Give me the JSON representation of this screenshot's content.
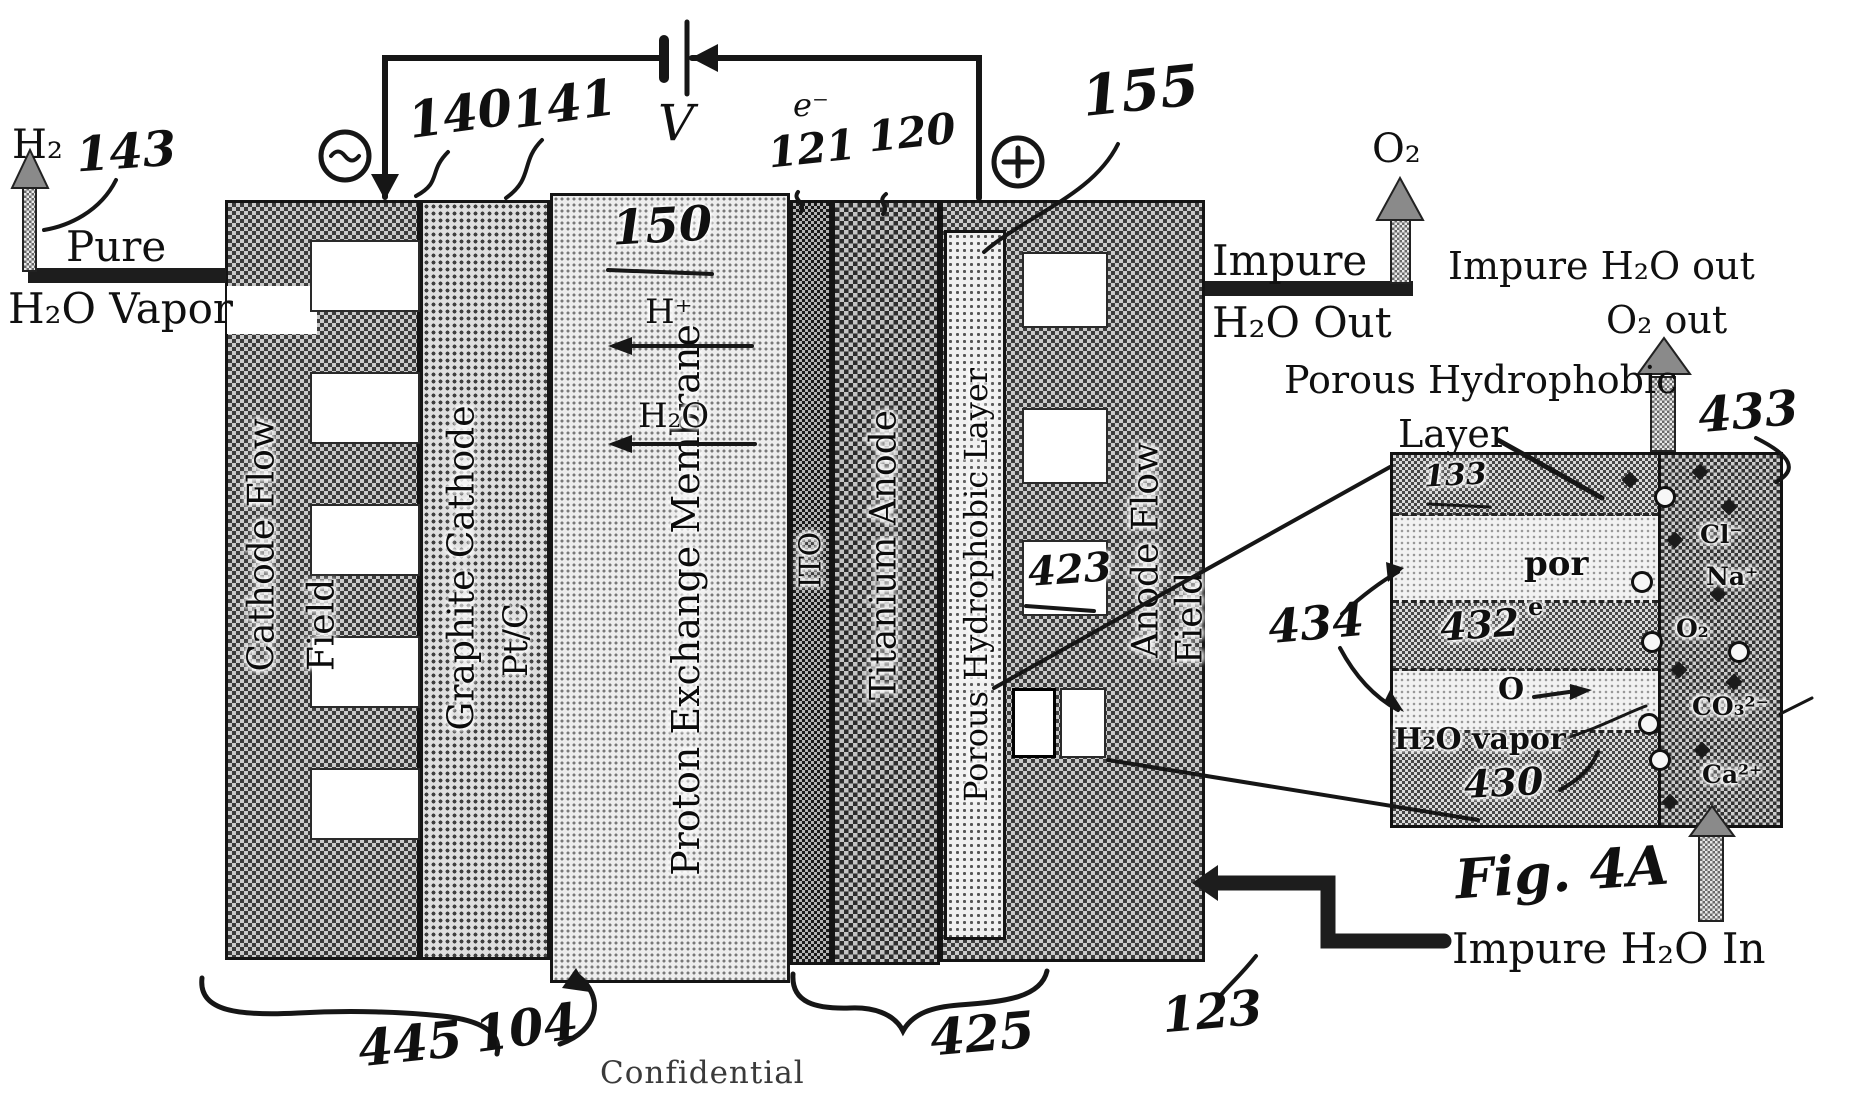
{
  "title": {
    "confidential": "Confidential",
    "fig_label": "Fig. 4A"
  },
  "circuit": {
    "voltage_label": "V",
    "electron_label": "e⁻",
    "refs": {
      "r140": "140",
      "r141": "141",
      "r121": "121",
      "r120": "120"
    }
  },
  "cathode_out": {
    "h2": "H₂",
    "r143": "143",
    "pure": "Pure",
    "h2o_vapor": "H₂O Vapor"
  },
  "anode_out": {
    "o2": "O₂",
    "impure": "Impure",
    "h2o_out": "H₂O Out"
  },
  "anode_in": {
    "impure_h2o_in": "Impure H₂O In",
    "r123": "123"
  },
  "cell": {
    "cathode_flow_1": "Cathode Flow",
    "cathode_flow_2": "Field",
    "graphite": "Graphite Cathode",
    "ptc": "Pt/C",
    "membrane": "Proton Exchange Membrane",
    "r150": "150",
    "h_plus": "H⁺",
    "h2o": "H₂O",
    "ito": "ITO",
    "titanium": "Titanium Anode",
    "porous": "Porous Hydrophobic Layer",
    "r155": "155",
    "anode_flow_1": "Anode Flow",
    "anode_flow_2": "Field",
    "r423": "423",
    "r445": "445",
    "r104": "104",
    "r425": "425"
  },
  "inset": {
    "impure_h2o_out": "Impure H₂O out",
    "o2_out": "O₂ out",
    "porous_1": "Porous Hydrophobic",
    "porous_2": "Layer",
    "r433": "433",
    "r434": "434",
    "r432": "432",
    "r430": "430",
    "r133": "133",
    "por": "por",
    "e": "e",
    "o": "O",
    "h2o_vapor": "H₂O vapor",
    "ions": {
      "cl": "Cl⁻",
      "na": "Na⁺",
      "o2": "O₂",
      "co3": "CO₃²⁻",
      "ca": "Ca²⁺"
    }
  }
}
